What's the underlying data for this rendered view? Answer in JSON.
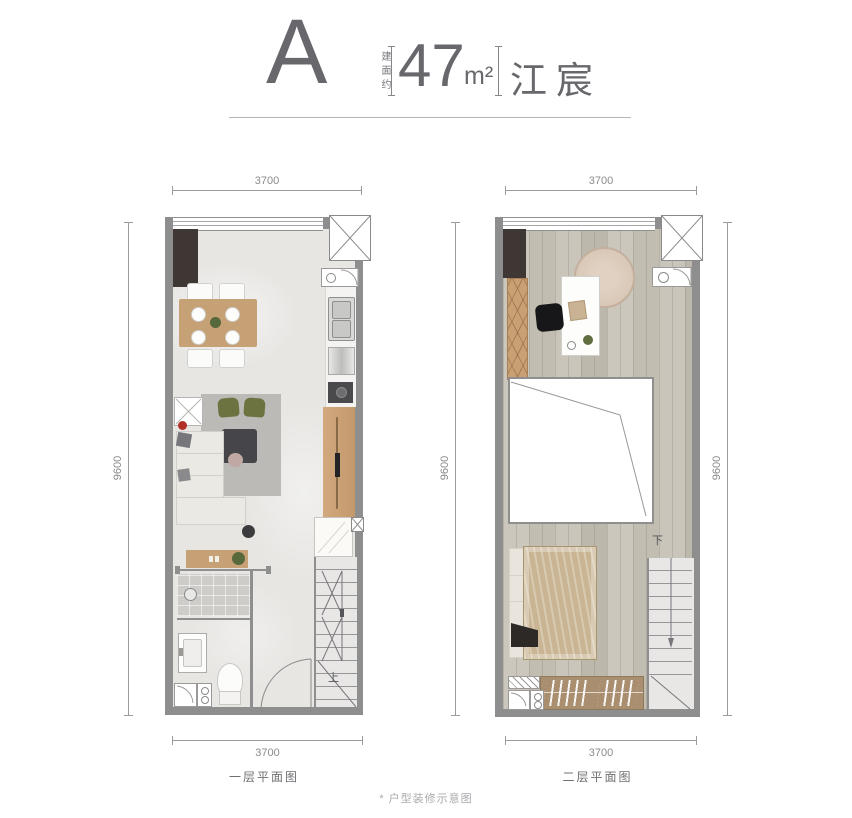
{
  "header": {
    "unit_letter": "A",
    "area_prefix": "建面约",
    "area_value": "47",
    "area_unit": "m²",
    "project_name": "江宸"
  },
  "plan_first": {
    "caption": "一层平面图",
    "dim_top": "3700",
    "dim_bottom": "3700",
    "dim_left": "9600",
    "stair_label": "上"
  },
  "plan_second": {
    "caption": "二层平面图",
    "dim_top": "3700",
    "dim_bottom": "3700",
    "dim_left": "9600",
    "dim_right": "9600",
    "stair_label": "下"
  },
  "footnote": {
    "text": "* 户型装修示意图"
  },
  "colors": {
    "wall": "#8e8e8e",
    "marble_floor": "#e7e6e3",
    "plank_floor": "#c8c3b8",
    "wood_furniture": "#c7a176",
    "dark_cabinet": "#3e3733",
    "accent_green": "#6d7340",
    "accent_red": "#b23127",
    "text": "#6c6b70"
  }
}
